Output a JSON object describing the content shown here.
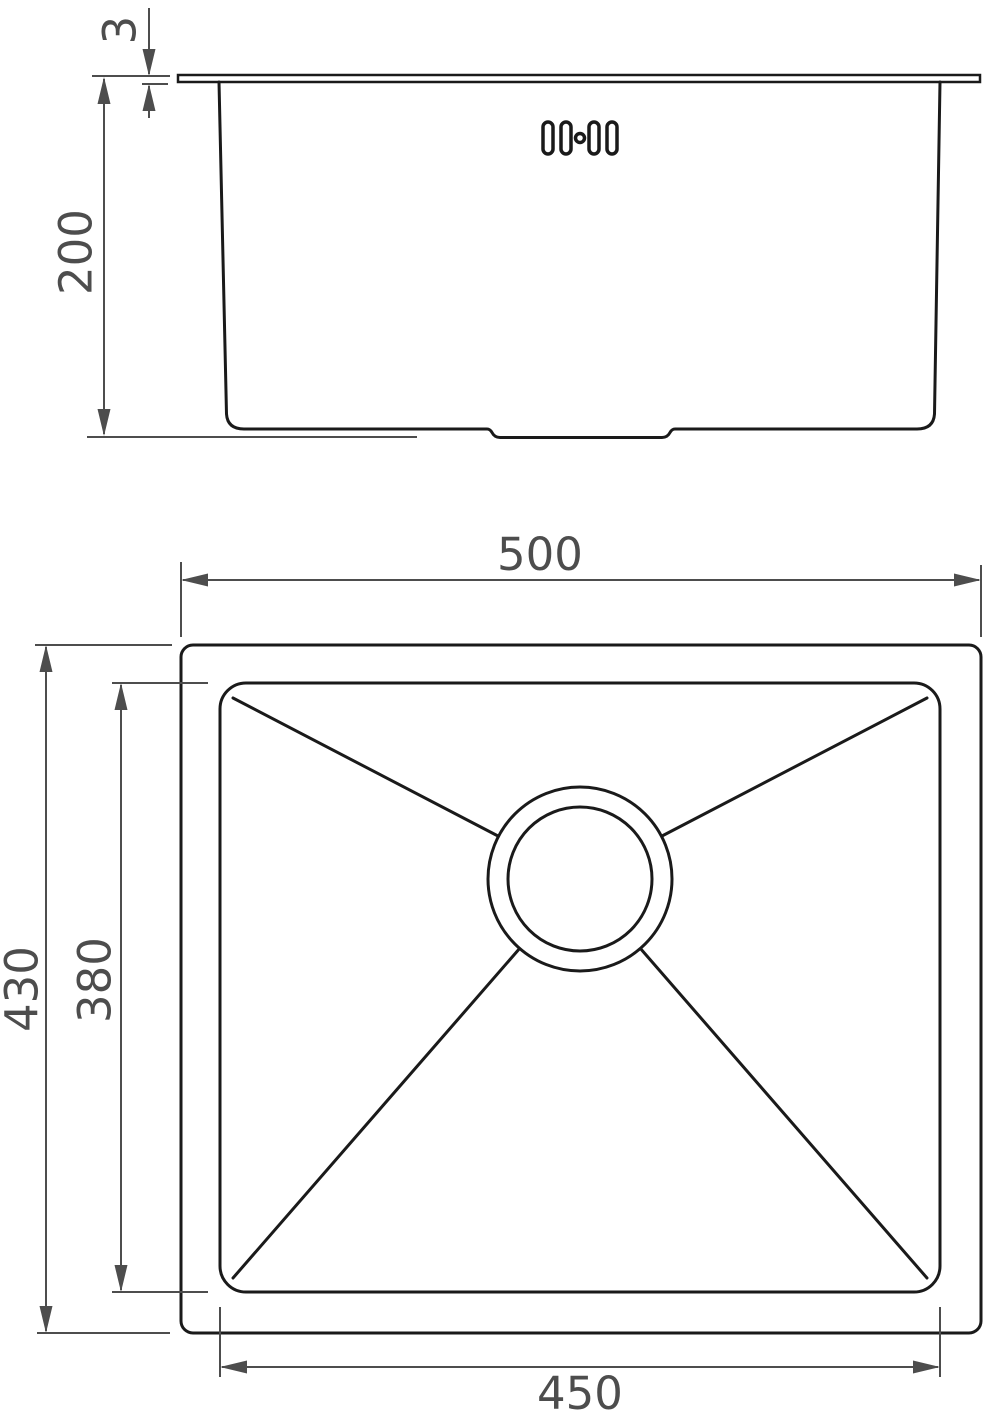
{
  "drawing": {
    "type": "technical-dimension-drawing",
    "subject": "undermount kitchen sink, front elevation and plan view",
    "colors": {
      "line": "#1a1a1a",
      "dimension": "#4d4d4d",
      "background": "#ffffff"
    },
    "views": {
      "front": {
        "label": "front-elevation",
        "icons": {
          "overflow": "overflow-holes-icon"
        },
        "dimensions": {
          "rim_thickness": {
            "value": "3"
          },
          "bowl_depth": {
            "value": "200"
          }
        }
      },
      "plan": {
        "label": "top-plan",
        "icons": {
          "drain": "drain-waste-icon"
        },
        "dimensions": {
          "overall_width": {
            "value": "500"
          },
          "overall_depth": {
            "value": "430"
          },
          "bowl_depth": {
            "value": "380"
          },
          "bowl_width": {
            "value": "450"
          }
        }
      }
    }
  }
}
